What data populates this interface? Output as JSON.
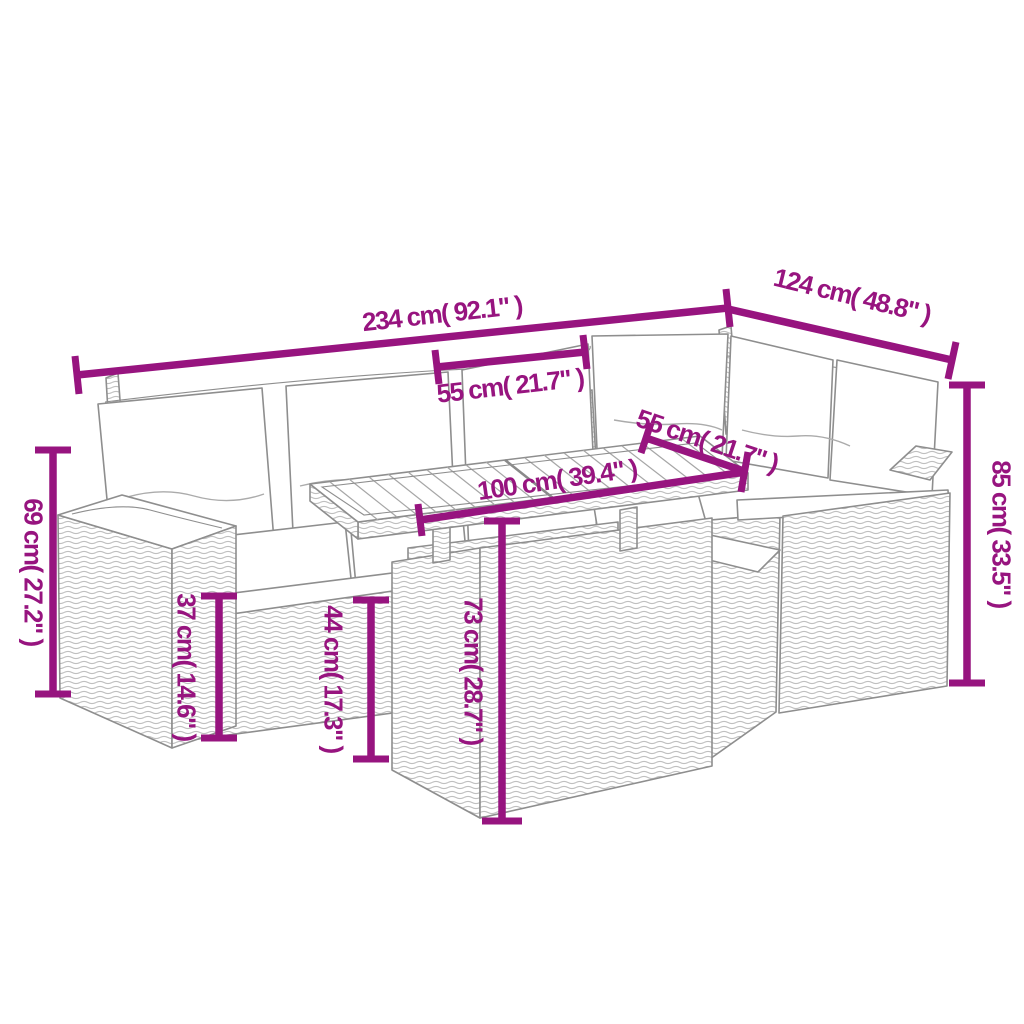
{
  "diagram": {
    "title": "Garden rattan corner sofa set with table - dimension diagram",
    "colors": {
      "accent": "#97147f",
      "line": "#8e8e8e"
    },
    "labels": {
      "dim_234": "234 cm( 92.1\" )",
      "dim_124": "124 cm( 48.8\" )",
      "dim_55_seat": "55 cm( 21.7\" )",
      "dim_55_table": "55 cm( 21.7\" )",
      "dim_100": "100 cm( 39.4\" )",
      "dim_69": "69 cm( 27.2\" )",
      "dim_37": "37 cm( 14.6\" )",
      "dim_44": "44 cm( 17.3\" )",
      "dim_73": "73 cm( 28.7\" )",
      "dim_85": "85 cm( 33.5\" )"
    }
  }
}
